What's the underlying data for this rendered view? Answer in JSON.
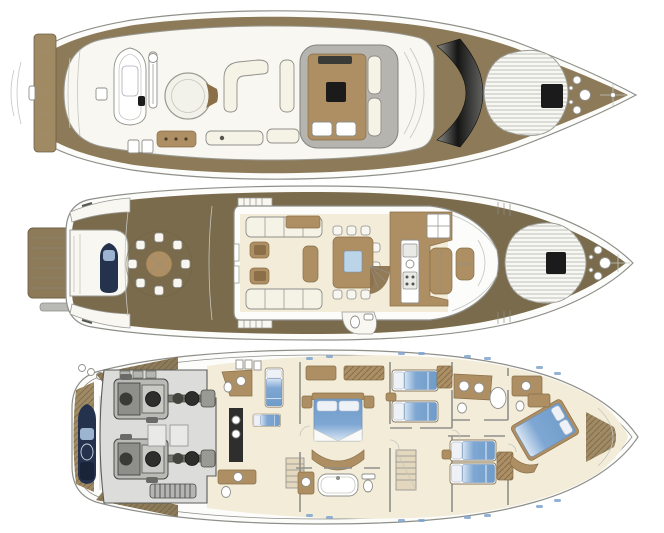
{
  "image": {
    "kind": "yacht-deck-plans",
    "views_count": 3,
    "width": 664,
    "height": 533
  },
  "colors": {
    "bg": "#ffffff",
    "line": "#8f8f8a",
    "line_dark": "#5c5c57",
    "line_faint": "#c6c6bf",
    "hull_white": "#fcfcfa",
    "deck_white": "#f8f7f1",
    "teak": "#8c7a58",
    "teak_dark": "#7a6b4c",
    "teak_light": "#a08a63",
    "cream": "#f2ecd9",
    "wood": "#ad8f63",
    "wood_dark": "#8a6f48",
    "sofa": "#f5f2e6",
    "gray_floor": "#dcdcda",
    "hardtop": "#b0b0ab",
    "glass": "#1b1b1b",
    "navy": "#24324d",
    "bed_blue": "#7fa7d3",
    "bed_blue_deep": "#6f9cc9",
    "bed_blue_light": "#d7e5f3",
    "porthole": "#7fa3cc",
    "machine_mid": "#9a9a96",
    "machine_dark": "#2e2e2c",
    "plank": "#6f6147"
  },
  "decks": [
    {
      "name": "flybridge-sun-deck",
      "position": "top",
      "features": [
        "aft-sunpad-overhang",
        "tender-on-chocks",
        "tender-crane",
        "jacuzzi-lounge-circle",
        "c-shaped-seating",
        "wet-bar",
        "sun-loungers",
        "hardtop-dinette",
        "helm-console",
        "radar-arch",
        "foredeck-sunpad",
        "deck-hatch",
        "anchor-windlass"
      ]
    },
    {
      "name": "main-deck",
      "position": "middle",
      "features": [
        "swim-platform",
        "passerelle",
        "tender-garage",
        "aft-deck-round-dining",
        "flybridge-stairs",
        "salon-sofas",
        "salon-armchairs",
        "salon-console",
        "dining-table-8-seats",
        "companionway-stairs",
        "day-head",
        "galley",
        "helm-station",
        "foredeck-sunpad",
        "deck-hatch",
        "anchor-windlass"
      ]
    },
    {
      "name": "lower-deck",
      "position": "bottom",
      "features": [
        "stern-garage-tender",
        "engine-room-twin-engines",
        "exhaust-muffler",
        "crew-cabin-bunks",
        "crew-bathroom",
        "crew-stairs",
        "master-cabin-double-bed",
        "master-sofa",
        "master-bathroom-tub",
        "staircase",
        "twin-guest-cabin-port",
        "twin-guest-cabin-starboard",
        "guest-bathrooms",
        "vip-cabin-double-bed",
        "bow-lockers",
        "portholes"
      ]
    }
  ]
}
